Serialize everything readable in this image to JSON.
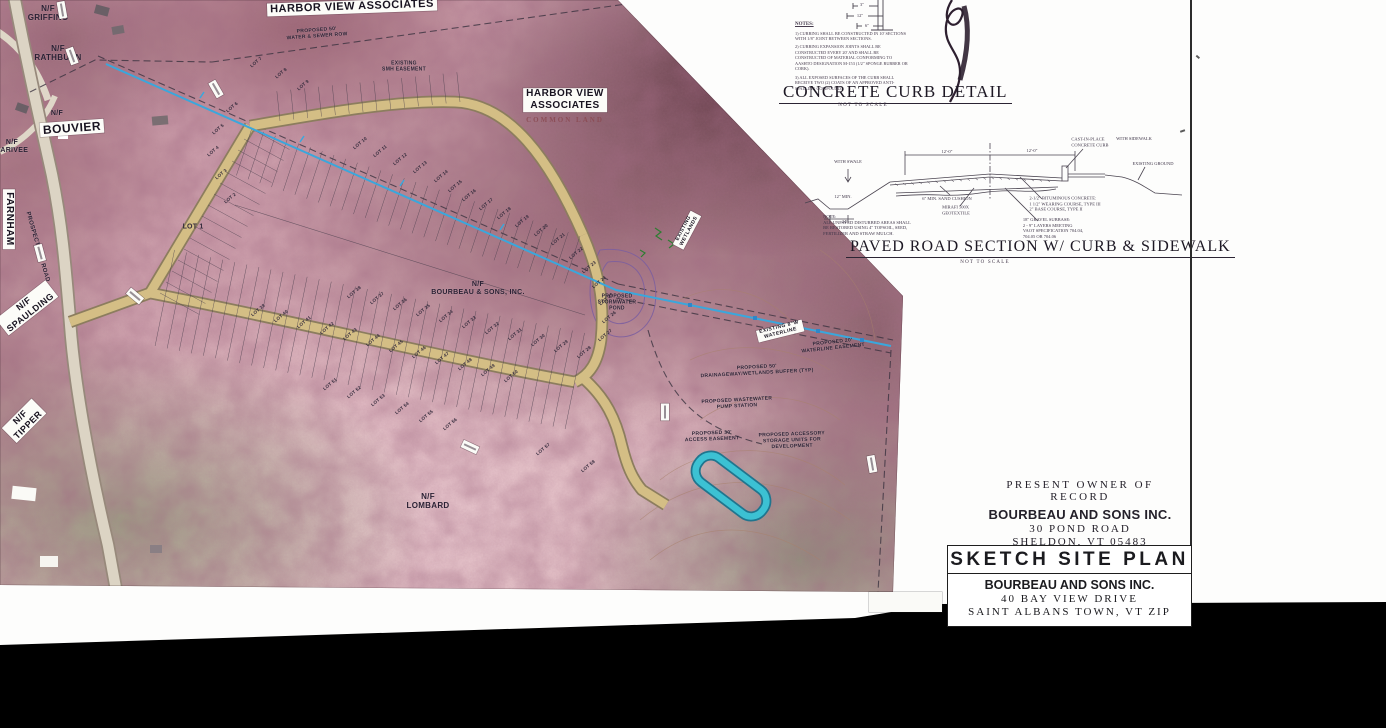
{
  "colors": {
    "photo_tint": "#d0a5af",
    "road_tan": "#d2bc82",
    "waterline_cyan": "#3aa7dc",
    "storage_teal": "#3cc1d3",
    "scan_margin": "#000000"
  },
  "map": {
    "area_labels": [
      {
        "t": "N/F\nGRIFFING",
        "x": 48,
        "y": 13,
        "r": 0,
        "cls": "hw",
        "fs": 8
      },
      {
        "t": "N/F\nRATHBURN",
        "x": 58,
        "y": 53,
        "r": 0,
        "cls": "hw",
        "fs": 8
      },
      {
        "t": "N/F",
        "x": 57,
        "y": 114,
        "r": 0,
        "cls": "hw",
        "fs": 7
      },
      {
        "t": "BOUVIER",
        "x": 72,
        "y": 128,
        "r": -4,
        "cls": "wl",
        "fs": 12
      },
      {
        "t": "N/F\nLARIVEE",
        "x": 12,
        "y": 147,
        "r": 0,
        "cls": "hw",
        "fs": 7
      },
      {
        "t": "FARNHAM",
        "x": 9,
        "y": 219,
        "r": 90,
        "cls": "wl",
        "fs": 10
      },
      {
        "t": "PROSPECT HILL ROAD",
        "x": 37,
        "y": 247,
        "r": 74,
        "cls": "hw",
        "fs": 6
      },
      {
        "t": "N/F\nSPAULDING",
        "x": 27,
        "y": 308,
        "r": -38,
        "cls": "wl",
        "fs": 9
      },
      {
        "t": "N/F\nTIPPER",
        "x": 24,
        "y": 421,
        "r": -45,
        "cls": "wl",
        "fs": 9
      },
      {
        "t": "HARBOR VIEW ASSOCIATES",
        "x": 352,
        "y": 7,
        "r": -2,
        "cls": "wl",
        "fs": 11
      },
      {
        "t": "PROPOSED 50'\nWATER & SEWER ROW",
        "x": 317,
        "y": 34,
        "r": -4,
        "cls": "hw",
        "fs": 5
      },
      {
        "t": "EXISTING\nSMH EASEMENT",
        "x": 404,
        "y": 67,
        "r": 0,
        "cls": "hw",
        "fs": 5
      },
      {
        "t": "HARBOR VIEW\nASSOCIATES",
        "x": 565,
        "y": 100,
        "r": 0,
        "cls": "wl",
        "fs": 10
      },
      {
        "t": "COMMON LAND",
        "x": 565,
        "y": 120,
        "r": 0,
        "cls": "fd",
        "fs": 7
      },
      {
        "t": "EXISTING\nWETLANDS",
        "x": 687,
        "y": 230,
        "r": -62,
        "cls": "wl",
        "fs": 5
      },
      {
        "t": "N/F\nBOURBEAU & SONS, INC.",
        "x": 478,
        "y": 289,
        "r": 0,
        "cls": "hw",
        "fs": 7
      },
      {
        "t": "PROPOSED\nSTORMWATER\nPOND",
        "x": 617,
        "y": 303,
        "r": 0,
        "cls": "hw",
        "fs": 5
      },
      {
        "t": "EXISTING 8\"W\nWATERLINE",
        "x": 780,
        "y": 331,
        "r": -14,
        "cls": "wl",
        "fs": 5
      },
      {
        "t": "PROPOSED 20'\nWATERLINE EASEMENT",
        "x": 833,
        "y": 346,
        "r": -6,
        "cls": "hw",
        "fs": 5
      },
      {
        "t": "PROPOSED 50'\nDRAINAGEWAY/WETLANDS  BUFFER (TYP)",
        "x": 757,
        "y": 371,
        "r": -3,
        "cls": "hw",
        "fs": 5
      },
      {
        "t": "PROPOSED WASTEWATER\nPUMP STATION",
        "x": 737,
        "y": 404,
        "r": -3,
        "cls": "hw",
        "fs": 5
      },
      {
        "t": "PROPOSED 30'\nACCESS EASEMENT",
        "x": 712,
        "y": 437,
        "r": -2,
        "cls": "hw",
        "fs": 5
      },
      {
        "t": "PROPOSED ACCESSORY\nSTORAGE UNITS FOR\nDEVELOPMENT",
        "x": 792,
        "y": 441,
        "r": -2,
        "cls": "hw",
        "fs": 5
      },
      {
        "t": "N/F\nLOMBARD",
        "x": 428,
        "y": 501,
        "r": 0,
        "cls": "hw",
        "fs": 8
      }
    ],
    "lots": [
      {
        "l": "LOT 1",
        "x": 193,
        "y": 227,
        "fs": 7,
        "r": 0
      },
      {
        "l": "LOT 2",
        "x": 230,
        "y": 198
      },
      {
        "l": "LOT 3",
        "x": 221,
        "y": 174
      },
      {
        "l": "LOT 4",
        "x": 213,
        "y": 151
      },
      {
        "l": "LOT 5",
        "x": 218,
        "y": 129
      },
      {
        "l": "LOT 6",
        "x": 232,
        "y": 107
      },
      {
        "l": "LOT 7",
        "x": 256,
        "y": 62
      },
      {
        "l": "LOT 8",
        "x": 281,
        "y": 73
      },
      {
        "l": "LOT 9",
        "x": 303,
        "y": 85
      },
      {
        "l": "LOT 10",
        "x": 360,
        "y": 143
      },
      {
        "l": "LOT 11",
        "x": 380,
        "y": 151
      },
      {
        "l": "LOT 12",
        "x": 400,
        "y": 159
      },
      {
        "l": "LOT 13",
        "x": 420,
        "y": 167
      },
      {
        "l": "LOT 14",
        "x": 441,
        "y": 176
      },
      {
        "l": "LOT 15",
        "x": 455,
        "y": 186
      },
      {
        "l": "LOT 16",
        "x": 469,
        "y": 195
      },
      {
        "l": "LOT 17",
        "x": 486,
        "y": 204
      },
      {
        "l": "LOT 18",
        "x": 504,
        "y": 213
      },
      {
        "l": "LOT 19",
        "x": 522,
        "y": 221
      },
      {
        "l": "LOT 20",
        "x": 541,
        "y": 230
      },
      {
        "l": "LOT 21",
        "x": 558,
        "y": 239
      },
      {
        "l": "LOT 22",
        "x": 576,
        "y": 253
      },
      {
        "l": "LOT 23",
        "x": 589,
        "y": 267
      },
      {
        "l": "LOT 24",
        "x": 599,
        "y": 282
      },
      {
        "l": "LOT 25",
        "x": 606,
        "y": 299
      },
      {
        "l": "LOT 26",
        "x": 609,
        "y": 317
      },
      {
        "l": "LOT 27",
        "x": 605,
        "y": 335
      },
      {
        "l": "LOT 28",
        "x": 584,
        "y": 352
      },
      {
        "l": "LOT 29",
        "x": 561,
        "y": 346
      },
      {
        "l": "LOT 30",
        "x": 538,
        "y": 340
      },
      {
        "l": "LOT 31",
        "x": 515,
        "y": 334
      },
      {
        "l": "LOT 32",
        "x": 492,
        "y": 328
      },
      {
        "l": "LOT 33",
        "x": 469,
        "y": 322
      },
      {
        "l": "LOT 34",
        "x": 446,
        "y": 316
      },
      {
        "l": "LOT 35",
        "x": 423,
        "y": 310
      },
      {
        "l": "LOT 36",
        "x": 400,
        "y": 304
      },
      {
        "l": "LOT 37",
        "x": 377,
        "y": 298
      },
      {
        "l": "LOT 38",
        "x": 354,
        "y": 292
      },
      {
        "l": "LOT 39",
        "x": 258,
        "y": 310
      },
      {
        "l": "LOT 40",
        "x": 281,
        "y": 316
      },
      {
        "l": "LOT 41",
        "x": 304,
        "y": 322
      },
      {
        "l": "LOT 42",
        "x": 327,
        "y": 328
      },
      {
        "l": "LOT 43",
        "x": 350,
        "y": 334
      },
      {
        "l": "LOT 44",
        "x": 373,
        "y": 340
      },
      {
        "l": "LOT 45",
        "x": 396,
        "y": 346
      },
      {
        "l": "LOT 46",
        "x": 419,
        "y": 352
      },
      {
        "l": "LOT 47",
        "x": 442,
        "y": 358
      },
      {
        "l": "LOT 48",
        "x": 465,
        "y": 364
      },
      {
        "l": "LOT 49",
        "x": 488,
        "y": 370
      },
      {
        "l": "LOT 50",
        "x": 511,
        "y": 376
      },
      {
        "l": "LOT 51",
        "x": 330,
        "y": 384
      },
      {
        "l": "LOT 52",
        "x": 354,
        "y": 392
      },
      {
        "l": "LOT 53",
        "x": 378,
        "y": 400
      },
      {
        "l": "LOT 54",
        "x": 402,
        "y": 408
      },
      {
        "l": "LOT 55",
        "x": 426,
        "y": 416
      },
      {
        "l": "LOT 56",
        "x": 450,
        "y": 424
      },
      {
        "l": "LOT 57",
        "x": 543,
        "y": 449
      },
      {
        "l": "LOT 58",
        "x": 588,
        "y": 466
      }
    ]
  },
  "curb_detail": {
    "title": "CONCRETE CURB DETAIL",
    "scale_note": "NOT TO SCALE",
    "notes_heading": "NOTES:",
    "notes": [
      "1) CURBING SHALL BE CONSTRUCTED IN 10' SECTIONS WITH 1/8\" JOINT BETWEEN SECTIONS.",
      "2) CURBING EXPANSION JOINTS SHALL BE CONSTRUCTED EVERY 20' AND SHALL BE CONSTRUCTED OF MATERIAL CONFORMING TO AASHTO DESIGNATION M-153 (1/2\" SPONGE RUBBER OR CORK).",
      "3) ALL EXPOSED SURFACES OF THE CURB SHALL RECEIVE TWO (2) COATS OF AN APPROVED ANTI-SPALLING COMPOUND."
    ],
    "callouts": [
      {
        "t": "3\"",
        "x": 862,
        "y": 5
      },
      {
        "t": "12\"",
        "x": 860,
        "y": 16
      },
      {
        "t": "6\"",
        "x": 867,
        "y": 26
      }
    ]
  },
  "road_detail": {
    "title": "PAVED ROAD SECTION W/ CURB & SIDEWALK",
    "scale_note": "NOT TO SCALE",
    "callouts": [
      {
        "t": "WITH SWALE",
        "x": 848,
        "y": 162
      },
      {
        "t": "12\" MIN.",
        "x": 843,
        "y": 197
      },
      {
        "t": "24\"",
        "x": 845,
        "y": 222
      },
      {
        "t": "NOTE:\nALL UNPAVED DISTURBED AREAS SHALL\nBE RESTORED USING 4\" TOPSOIL, SEED,\nFERTILIZER AND STRAW MULCH.",
        "x": 867,
        "y": 225
      },
      {
        "t": "6\" MIN. SAND CUSHION",
        "x": 947,
        "y": 199
      },
      {
        "t": "MIRAFI 500X\nGEOTEXTILE",
        "x": 956,
        "y": 210
      },
      {
        "t": "12'-0\"",
        "x": 947,
        "y": 152
      },
      {
        "t": "12'-0\"",
        "x": 1032,
        "y": 151
      },
      {
        "t": "CAST-IN-PLACE\nCONCRETE CURB",
        "x": 1090,
        "y": 142
      },
      {
        "t": "WITH SIDEWALK",
        "x": 1134,
        "y": 139
      },
      {
        "t": "EXISTING GROUND",
        "x": 1153,
        "y": 164
      },
      {
        "t": "2-1/2\" BITUMINOUS CONCRETE:\n1 1/2\" WEARING COURSE, TYPE III\n2\" BASE COURSE, TYPE II",
        "x": 1065,
        "y": 204
      },
      {
        "t": "18\" GRAVEL SUBBASE:\n2 - 9\" LAYERS MEETING\nVAOT SPECIFICATION 704.04,\n704.05 OR 704.06",
        "x": 1053,
        "y": 228
      }
    ]
  },
  "owner_block": {
    "heading": "PRESENT  OWNER  OF  RECORD",
    "name": "BOURBEAU AND SONS INC.",
    "address1": "30  POND  ROAD",
    "address2": "SHELDON,  VT  05483"
  },
  "title_block": {
    "title": "SKETCH SITE PLAN",
    "name": "BOURBEAU AND SONS INC.",
    "address1": "40  BAY  VIEW  DRIVE",
    "address2": "SAINT  ALBANS  TOWN,  VT  ZIP"
  }
}
